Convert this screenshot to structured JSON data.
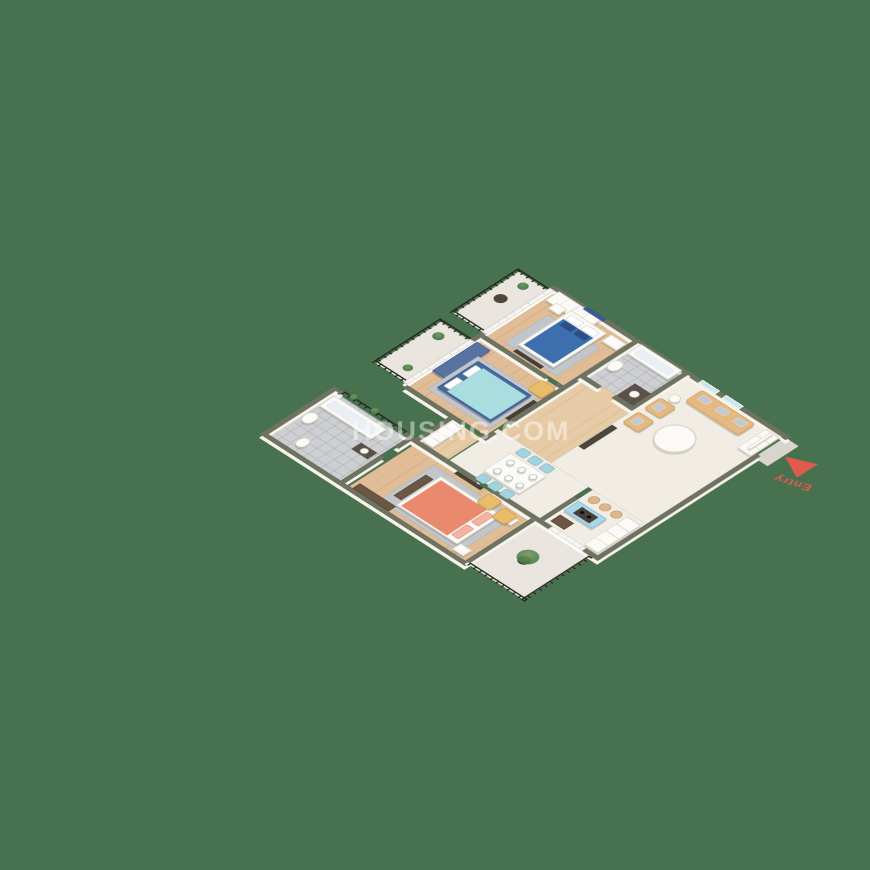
{
  "title": "3D isometric apartment floor plan render",
  "background_color": "#48724f",
  "entry": {
    "label": "Entry",
    "color": "#e05a4e"
  },
  "watermark": {
    "text": "HOUSING.COM"
  },
  "palette": {
    "wall_top": "#6e7260",
    "wall_face": "#f7f4ec",
    "wood_floor": "#e0bd96",
    "marble_floor": "#f1ece4",
    "bathroom_tile": "#cdcfd2",
    "balcony_floor": "#eae6df",
    "bed_blue": "#3d6fae",
    "bed_teal": "#a9dde0",
    "bed_coral": "#e98a6f",
    "sofa_tan": "#e5b97f",
    "armchair_yellow": "#e9bd68",
    "dining_chair_blue": "#a3d3de",
    "kitchen_counter_blue": "#a9d6e8",
    "wardrobe_navy": "#5872a2",
    "railing_black": "#26261f",
    "entry_red": "#e05a4e"
  }
}
